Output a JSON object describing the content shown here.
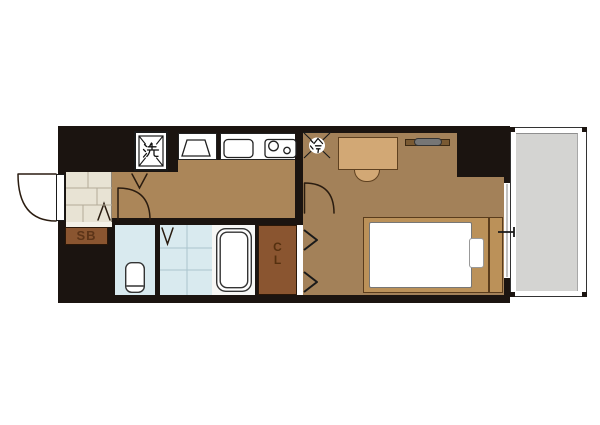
{
  "floor_plan": {
    "labels": {
      "shoe_box": "SB",
      "closet_top": "C",
      "closet_bottom": "L"
    },
    "symbols": {
      "washing_machine": "洗",
      "refrigerator": "冷"
    },
    "colors": {
      "wall": "#1b1410",
      "hall_kitchen_floor": "#ab8659",
      "bedroom_floor": "#a38159",
      "entry_tile": "#e8e3d4",
      "wet_area": "#d9eaef",
      "closet_brown": "#8a5530",
      "shoe_box_brown": "#8a5530",
      "balcony_gray": "#d4d4d2",
      "furniture_tan": "#d2a875",
      "bed_frame": "#bb9159",
      "tv_gray": "#767676"
    },
    "rooms": [
      "entry",
      "hallway-kitchen",
      "toilet",
      "bathroom",
      "closet",
      "bedroom",
      "balcony"
    ],
    "furniture": [
      "washing-machine-space",
      "kitchen-sink",
      "gas-stove",
      "refrigerator-space",
      "desk",
      "chair",
      "tv",
      "bed",
      "toilet",
      "bathtub",
      "shoe-box"
    ]
  }
}
